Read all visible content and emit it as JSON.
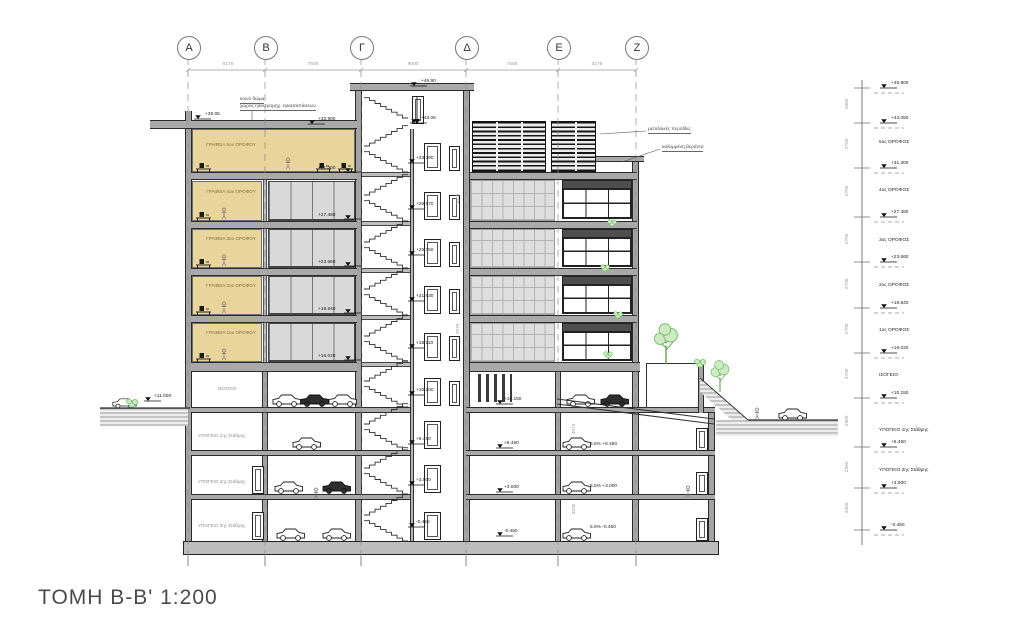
{
  "title": "ΤΟΜΗ Β-Β' 1:200",
  "grid": {
    "labels": [
      "Α",
      "Β",
      "Γ",
      "Δ",
      "Ε",
      "Ζ"
    ],
    "dims": [
      "6175",
      "7500",
      "9000",
      "7500",
      "6175"
    ]
  },
  "rooms": {
    "offices": [
      "ΓΡΑΦΕΙΑ 5ου ΟΡΟΦΟΥ",
      "ΓΡΑΦΕΙΑ 4ου ΟΡΟΦΟΥ",
      "ΓΡΑΦΕΙΑ 3ου ΟΡΟΦΟΥ",
      "ΓΡΑΦΕΙΑ 2ου ΟΡΟΦΟΥ",
      "ΓΡΑΦΕΙΑ 1ου ΟΡΟΦΟΥ"
    ],
    "ground": "ΙΣΟΓΕΙΟ",
    "basements": [
      "ΥΠΟΓΕΙΟ 1ης Στάθμης",
      "ΥΠΟΓΕΙΟ 2ης Στάθμης",
      "ΥΠΟΓΕΙΟ 3ης Στάθμης"
    ]
  },
  "notes": {
    "roof1": "κοινό δώμα",
    "roof2": "χώρος ηλεκτρομηχ. εγκαταστάσεων",
    "louvers": "μεταλλικές περσίδες",
    "veranda": "καλυμμένη βεράντα"
  },
  "marks": {
    "tower_top": "+46.90",
    "machine": "+43.05",
    "roof_left": "+35.05",
    "roof_right": "+32.900",
    "street_left": "+11.000",
    "ground_tower": "+10.200",
    "ground_center": "+10.150",
    "b1": "+6.450",
    "b2": "+3.000",
    "b3": "-0.450",
    "landings": [
      "+33.390",
      "+29.570",
      "+25.750",
      "+21.930",
      "+18.110"
    ],
    "floors_left": [
      "+31.300",
      "+27.480",
      "+23.660",
      "+19.840",
      "+16.020"
    ],
    "ramp": [
      "5.5% +6.450",
      "5.5% +3.000",
      "5.5% -0.450"
    ]
  },
  "rcol": {
    "marks": [
      "+45.800",
      "+43.050",
      "+31.300",
      "+27.480",
      "+23.660",
      "+19.840",
      "+16.020",
      "+10.150",
      "+6.450",
      "+3.000",
      "-0.450"
    ],
    "labels": [
      "5ος ΟΡΟΦΟΣ",
      "4ος ΟΡΟΦΟΣ",
      "3ος ΟΡΟΦΟΣ",
      "2ος ΟΡΟΦΟΣ",
      "1ος ΟΡΟΦΟΣ",
      "ΙΣΟΓΕΙΟ",
      "ΥΠΟΓΕΙΟ 1ης Στάθμης",
      "ΥΠΟΓΕΙΟ 2ης Στάθμης"
    ],
    "dims": [
      "2650",
      "2700",
      "2700",
      "2700",
      "2700",
      "2700",
      "3700",
      "2950",
      "2950",
      "3450"
    ]
  },
  "inner_dims": [
    "3025",
    "3075",
    "3075",
    "3035"
  ]
}
